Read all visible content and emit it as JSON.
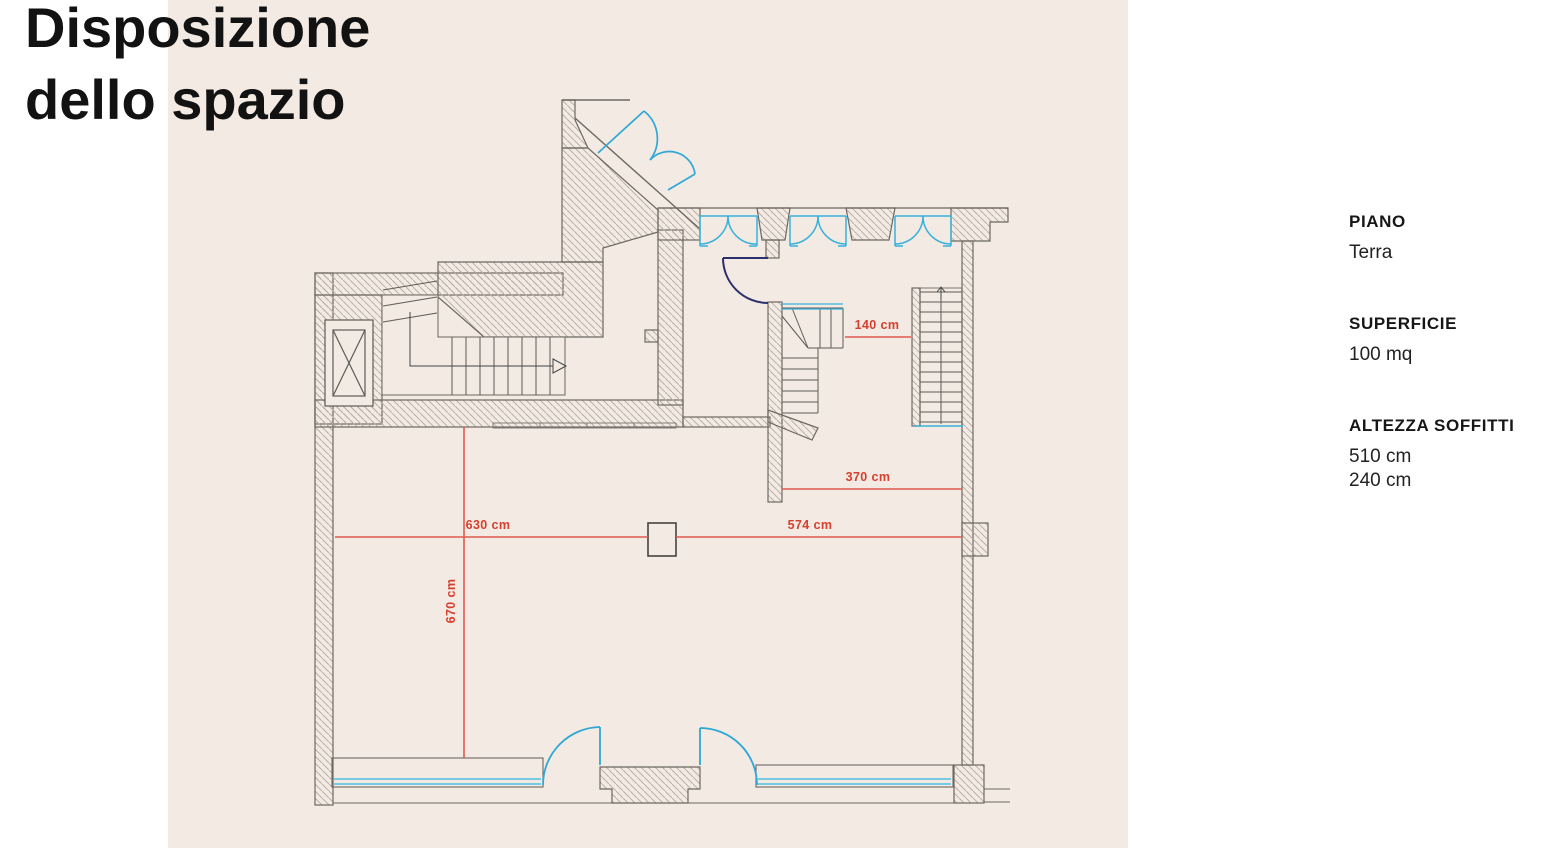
{
  "title": {
    "line1": "Disposizione",
    "line2": "dello spazio"
  },
  "info_panel": {
    "piano": {
      "label": "PIANO",
      "value": "Terra"
    },
    "superficie": {
      "label": "SUPERFICIE",
      "value": "100 mq"
    },
    "altezza": {
      "label": "ALTEZZA SOFFITTI",
      "value_1": "510 cm",
      "value_2": "240 cm"
    }
  },
  "floor_plan": {
    "dimensions": {
      "dim_140": "140 cm",
      "dim_370": "370 cm",
      "dim_630": "630 cm",
      "dim_574": "574 cm",
      "dim_670": "670 cm"
    }
  },
  "colors": {
    "panel_background": "#f2eae3",
    "wall_outline": "#6d6862",
    "hatch_line": "#b9b0a7",
    "window_cyan": "#38b1da",
    "door_navy": "#2b2f6e",
    "dimension_red": "#d6402e",
    "title_text": "#121212"
  }
}
